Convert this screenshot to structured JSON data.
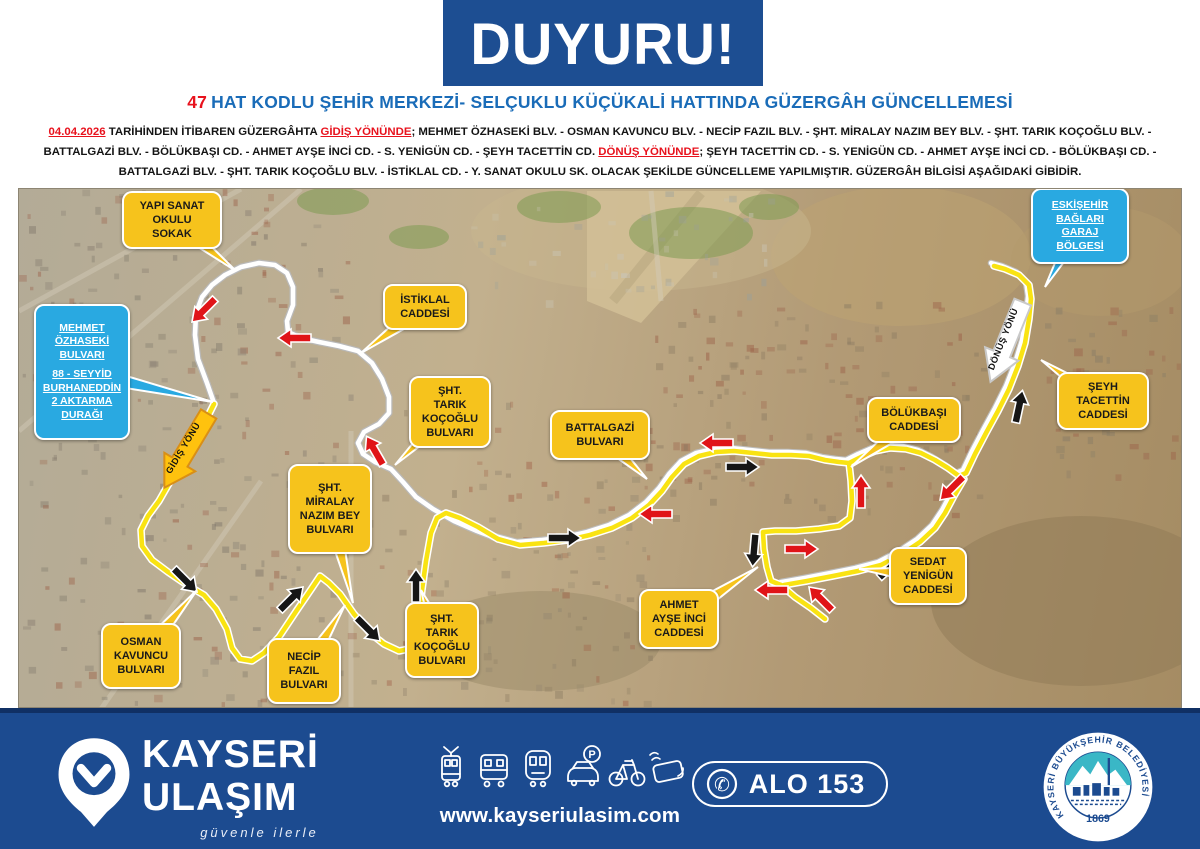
{
  "header": {
    "banner": "DUYURU!",
    "title_number": "47",
    "title_rest": "HAT KODLU ŞEHİR MERKEZİ- SELÇUKLU KÜÇÜKALİ HATTINDA GÜZERGÂH GÜNCELLEMESİ",
    "paragraph_segments": [
      {
        "text": "04.04.2026",
        "style": "red-underline"
      },
      {
        "text": " TARİHİNDEN İTİBAREN GÜZERGÂHTA ",
        "style": ""
      },
      {
        "text": "GİDİŞ YÖNÜNDE",
        "style": "red-underline"
      },
      {
        "text": "; MEHMET ÖZHASEKİ BLV.  - OSMAN KAVUNCU BLV. - NECİP FAZIL BLV. - ŞHT. MİRALAY NAZIM BEY BLV. - ŞHT. TARIK KOÇOĞLU BLV. -",
        "style": ""
      },
      {
        "break": true
      },
      {
        "text": "BATTALGAZİ BLV. - BÖLÜKBAŞI CD. - AHMET AYŞE İNCİ CD. - S. YENİGÜN CD. - ŞEYH TACETTİN CD.  ",
        "style": ""
      },
      {
        "text": "DÖNÜŞ YÖNÜNDE",
        "style": "red-underline"
      },
      {
        "text": "; ŞEYH TACETTİN CD. - S. YENİGÜN CD. - AHMET AYŞE İNCİ CD. - BÖLÜKBAŞI CD. -",
        "style": ""
      },
      {
        "break": true
      },
      {
        "text": "BATTALGAZİ BLV. - ŞHT. TARIK KOÇOĞLU BLV. - İSTİKLAL CD. - Y. SANAT OKULU SK. OLACAK ŞEKİLDE GÜNCELLEME YAPILMIŞTIR. GÜZERGÂH BİLGİSİ AŞAĞIDAKİ GİBİDİR.",
        "style": ""
      }
    ]
  },
  "map": {
    "labels": [
      {
        "id": "yapi-sanat-okulu-sokak",
        "type": "street",
        "lines": [
          "YAPI SANAT",
          "OKULU",
          "SOKAK"
        ],
        "x": 121,
        "y": 190,
        "w": 100,
        "h": 58,
        "tail": [
          235,
          270
        ]
      },
      {
        "id": "istiklal-caddesi",
        "type": "street",
        "lines": [
          "İSTİKLAL",
          "CADDESİ"
        ],
        "x": 382,
        "y": 283,
        "w": 84,
        "h": 46,
        "tail": [
          360,
          352
        ]
      },
      {
        "id": "sht-tarik-kocoglu-bulvari-1",
        "type": "street",
        "lines": [
          "ŞHT.",
          "TARIK",
          "KOÇOĞLU",
          "BULVARI"
        ],
        "x": 408,
        "y": 375,
        "w": 82,
        "h": 72,
        "tail": [
          394,
          464
        ]
      },
      {
        "id": "battalgazi-bulvari",
        "type": "street",
        "lines": [
          "BATTALGAZİ",
          "BULVARI"
        ],
        "x": 549,
        "y": 409,
        "w": 100,
        "h": 50,
        "tail": [
          646,
          478
        ]
      },
      {
        "id": "sht-miralay-nazim-bey-bulvari",
        "type": "street",
        "lines": [
          "ŞHT.",
          "MİRALAY",
          "NAZIM BEY",
          "BULVARI"
        ],
        "x": 287,
        "y": 463,
        "w": 84,
        "h": 90,
        "tail": [
          352,
          602
        ]
      },
      {
        "id": "osman-kavuncu-bulvari",
        "type": "street",
        "lines": [
          "OSMAN",
          "KAVUNCU",
          "BULVARI"
        ],
        "x": 100,
        "y": 622,
        "w": 80,
        "h": 66,
        "tail": [
          196,
          589
        ]
      },
      {
        "id": "necip-fazil-bulvari",
        "type": "street",
        "lines": [
          "NECİP",
          "FAZIL",
          "BULVARI"
        ],
        "x": 266,
        "y": 637,
        "w": 74,
        "h": 66,
        "tail": [
          344,
          604
        ]
      },
      {
        "id": "sht-tarik-kocoglu-bulvari-2",
        "type": "street",
        "lines": [
          "ŞHT.",
          "TARIK",
          "KOÇOĞLU",
          "BULVARI"
        ],
        "x": 404,
        "y": 601,
        "w": 74,
        "h": 76,
        "tail": [
          420,
          589
        ]
      },
      {
        "id": "ahmet-ayse-inci-caddesi",
        "type": "street",
        "lines": [
          "AHMET",
          "AYŞE İNCİ",
          "CADDESİ"
        ],
        "x": 638,
        "y": 588,
        "w": 80,
        "h": 60,
        "tail": [
          757,
          566
        ]
      },
      {
        "id": "sedat-yenigun-caddesi",
        "type": "street",
        "lines": [
          "SEDAT",
          "YENİGÜN",
          "CADDESİ"
        ],
        "x": 888,
        "y": 546,
        "w": 78,
        "h": 58,
        "tail": [
          858,
          568
        ]
      },
      {
        "id": "bolukbasi-caddesi",
        "type": "street",
        "lines": [
          "BÖLÜKBAŞI",
          "CADDESİ"
        ],
        "x": 866,
        "y": 396,
        "w": 94,
        "h": 46,
        "tail": [
          850,
          466
        ]
      },
      {
        "id": "seyh-tacettin-caddesi",
        "type": "street",
        "lines": [
          "ŞEYH",
          "TACETTİN",
          "CADDESİ"
        ],
        "x": 1056,
        "y": 371,
        "w": 92,
        "h": 58,
        "tail": [
          1040,
          359
        ]
      },
      {
        "id": "mehmet-ozhaseki-transfer",
        "type": "info",
        "lines": [
          "MEHMET",
          "ÖZHASEKİ",
          "BULVARI",
          "",
          "88 - SEYYİD",
          "BURHANEDDİN",
          "2 AKTARMA",
          "DURAĞI"
        ],
        "x": 33,
        "y": 303,
        "w": 96,
        "h": 136,
        "tail": [
          212,
          401
        ]
      },
      {
        "id": "eskisehir-baglari-garaj",
        "type": "info",
        "lines": [
          "ESKİŞEHİR",
          "BAĞLARI",
          "GARAJ",
          "BÖLGESİ"
        ],
        "x": 1030,
        "y": 187,
        "w": 98,
        "h": 76,
        "tail": [
          1044,
          286
        ]
      }
    ],
    "direction_markers": [
      {
        "id": "gidis-yonu-arrow",
        "label": "GİDİŞ YÖNÜ",
        "x": 186,
        "y": 449,
        "rot": 121,
        "fill": "#ffc20e",
        "stroke": "#d98f16"
      },
      {
        "id": "donus-yonu-arrow",
        "label": "DÖNÜŞ YÖNÜ",
        "x": 1006,
        "y": 340,
        "rot": 112,
        "fill": "#ffffff",
        "stroke": "#c9c9c9"
      }
    ],
    "routes": {
      "white_loop": [
        [
          213,
          402
        ],
        [
          206,
          382
        ],
        [
          197,
          358
        ],
        [
          194,
          334
        ],
        [
          195,
          312
        ],
        [
          201,
          296
        ],
        [
          211,
          284
        ],
        [
          224,
          274
        ],
        [
          240,
          266
        ],
        [
          258,
          262
        ],
        [
          274,
          264
        ],
        [
          286,
          272
        ],
        [
          292,
          286
        ],
        [
          292,
          304
        ],
        [
          286,
          320
        ],
        [
          287,
          331
        ],
        [
          300,
          337
        ],
        [
          318,
          341
        ],
        [
          338,
          345
        ],
        [
          357,
          350
        ],
        [
          371,
          362
        ],
        [
          381,
          378
        ],
        [
          388,
          396
        ],
        [
          388,
          412
        ],
        [
          378,
          423
        ],
        [
          363,
          431
        ],
        [
          357,
          442
        ],
        [
          362,
          453
        ],
        [
          374,
          461
        ],
        [
          390,
          468
        ],
        [
          402,
          481
        ],
        [
          415,
          496
        ],
        [
          432,
          508
        ],
        [
          453,
          520
        ],
        [
          476,
          530
        ],
        [
          497,
          538
        ]
      ],
      "shared": [
        [
          497,
          538
        ],
        [
          519,
          544
        ],
        [
          543,
          542
        ],
        [
          567,
          539
        ],
        [
          589,
          534
        ],
        [
          611,
          527
        ],
        [
          631,
          517
        ],
        [
          648,
          504
        ],
        [
          661,
          490
        ],
        [
          671,
          476
        ],
        [
          683,
          463
        ],
        [
          698,
          455
        ],
        [
          715,
          451
        ],
        [
          733,
          450
        ],
        [
          752,
          452
        ],
        [
          771,
          454
        ],
        [
          790,
          454
        ],
        [
          808,
          455
        ],
        [
          824,
          459
        ],
        [
          838,
          461
        ],
        [
          848,
          462
        ],
        [
          860,
          456
        ],
        [
          874,
          450
        ],
        [
          889,
          447
        ],
        [
          905,
          448
        ],
        [
          920,
          452
        ],
        [
          934,
          459
        ],
        [
          947,
          467
        ],
        [
          958,
          475
        ],
        [
          965,
          472
        ],
        [
          974,
          453
        ],
        [
          985,
          432
        ],
        [
          997,
          410
        ],
        [
          1008,
          388
        ],
        [
          1017,
          365
        ],
        [
          1024,
          342
        ],
        [
          1028,
          318
        ],
        [
          1030,
          298
        ],
        [
          1028,
          284
        ],
        [
          1018,
          274
        ],
        [
          1004,
          268
        ],
        [
          993,
          265
        ]
      ],
      "shared_lower": [
        [
          963,
          478
        ],
        [
          953,
          495
        ],
        [
          944,
          512
        ],
        [
          934,
          527
        ],
        [
          919,
          541
        ],
        [
          901,
          553
        ],
        [
          880,
          564
        ],
        [
          857,
          570
        ],
        [
          832,
          575
        ],
        [
          806,
          580
        ],
        [
          783,
          584
        ]
      ],
      "yellow_west": [
        [
          213,
          403
        ],
        [
          203,
          423
        ],
        [
          188,
          450
        ],
        [
          170,
          479
        ],
        [
          158,
          500
        ],
        [
          147,
          515
        ],
        [
          140,
          529
        ],
        [
          141,
          545
        ],
        [
          151,
          559
        ],
        [
          167,
          571
        ],
        [
          186,
          584
        ],
        [
          203,
          594
        ],
        [
          215,
          608
        ],
        [
          226,
          628
        ],
        [
          231,
          647
        ],
        [
          239,
          658
        ],
        [
          251,
          660
        ],
        [
          263,
          652
        ],
        [
          278,
          636
        ],
        [
          296,
          609
        ],
        [
          311,
          587
        ],
        [
          319,
          575
        ],
        [
          328,
          582
        ],
        [
          339,
          593
        ],
        [
          353,
          613
        ],
        [
          369,
          632
        ],
        [
          383,
          643
        ],
        [
          398,
          650
        ],
        [
          408,
          648
        ],
        [
          415,
          638
        ],
        [
          418,
          616
        ],
        [
          421,
          589
        ],
        [
          425,
          560
        ],
        [
          430,
          532
        ],
        [
          436,
          517
        ],
        [
          445,
          512
        ],
        [
          459,
          517
        ],
        [
          477,
          526
        ],
        [
          497,
          538
        ]
      ],
      "yellow_loop": [
        [
          848,
          462
        ],
        [
          850,
          480
        ],
        [
          851,
          500
        ],
        [
          849,
          517
        ],
        [
          838,
          525
        ],
        [
          818,
          528
        ],
        [
          795,
          530
        ],
        [
          774,
          530
        ],
        [
          762,
          531
        ],
        [
          763,
          548
        ],
        [
          766,
          566
        ],
        [
          770,
          580
        ],
        [
          780,
          584
        ]
      ],
      "yellow_spur": [
        [
          780,
          584
        ],
        [
          794,
          596
        ],
        [
          810,
          607
        ],
        [
          824,
          618
        ]
      ]
    },
    "arrows": {
      "red": [
        [
          203,
          309,
          135
        ],
        [
          294,
          337,
          180
        ],
        [
          374,
          450,
          240
        ],
        [
          655,
          513,
          180
        ],
        [
          716,
          442,
          180
        ],
        [
          860,
          491,
          270
        ],
        [
          951,
          487,
          135
        ],
        [
          800,
          548,
          0
        ],
        [
          771,
          589,
          180
        ],
        [
          820,
          598,
          225
        ]
      ],
      "black": [
        [
          184,
          579,
          45
        ],
        [
          290,
          598,
          315
        ],
        [
          367,
          628,
          45
        ],
        [
          415,
          585,
          270
        ],
        [
          563,
          537,
          0
        ],
        [
          741,
          466,
          0
        ],
        [
          890,
          566,
          318
        ],
        [
          1018,
          406,
          282
        ],
        [
          753,
          549,
          95
        ]
      ]
    },
    "texture": {
      "terrain": [
        [
          900,
          255,
          130,
          70,
          "#bda371"
        ],
        [
          1080,
          600,
          150,
          85,
          "#8f7a55"
        ],
        [
          540,
          640,
          120,
          50,
          "#9a8a68"
        ],
        [
          1100,
          260,
          90,
          55,
          "#b39a6c"
        ],
        [
          640,
          230,
          170,
          60,
          "#c7b68d"
        ]
      ],
      "greens": [
        [
          690,
          232,
          62,
          26
        ],
        [
          558,
          206,
          42,
          16
        ],
        [
          332,
          200,
          36,
          14
        ],
        [
          768,
          206,
          30,
          13
        ],
        [
          418,
          236,
          30,
          12
        ]
      ],
      "zones": [
        {
          "x": 18,
          "y": 188,
          "w": 330,
          "h": 515,
          "n": 240,
          "c": [
            "#7d7468",
            "#9b5f48",
            "#8a8274"
          ]
        },
        {
          "x": 350,
          "y": 400,
          "w": 300,
          "h": 300,
          "n": 130,
          "c": [
            "#8a7a62",
            "#a05f46",
            "#93866f"
          ]
        },
        {
          "x": 640,
          "y": 300,
          "w": 340,
          "h": 215,
          "n": 150,
          "c": [
            "#9b5f48",
            "#8a7a62"
          ]
        },
        {
          "x": 1040,
          "y": 300,
          "w": 140,
          "h": 180,
          "n": 55,
          "c": [
            "#9b5f48",
            "#877c66"
          ]
        },
        {
          "x": 470,
          "y": 190,
          "w": 300,
          "h": 110,
          "n": 45,
          "c": [
            "#c9c4b4",
            "#9aa09a"
          ]
        }
      ]
    }
  },
  "footer": {
    "brand_line1": "KAYSERİ",
    "brand_line2": "ULAŞIM",
    "tagline": "güvenle ilerle",
    "website": "www.kayseriulasim.com",
    "phone_label": "ALO 153",
    "seal_text": "KAYSERİ BÜYÜKŞEHİR BELEDİYESİ",
    "seal_year": "1869",
    "icons": [
      "tram-icon",
      "bus-icon",
      "metro-icon",
      "car-parking-icon",
      "bicycle-icon",
      "contactless-card-icon",
      "phone-icon"
    ]
  },
  "colors": {
    "navy": "#1d4e92",
    "footer_navy": "#1c4b90",
    "title_blue": "#1a6cb8",
    "alert_red": "#e8121d",
    "callout_yellow": "#f6c31c",
    "callout_blue": "#29a9e1",
    "route_yellow": "#f9e312",
    "route_white": "#ffffff",
    "seal_teal": "#3ab7c6"
  }
}
